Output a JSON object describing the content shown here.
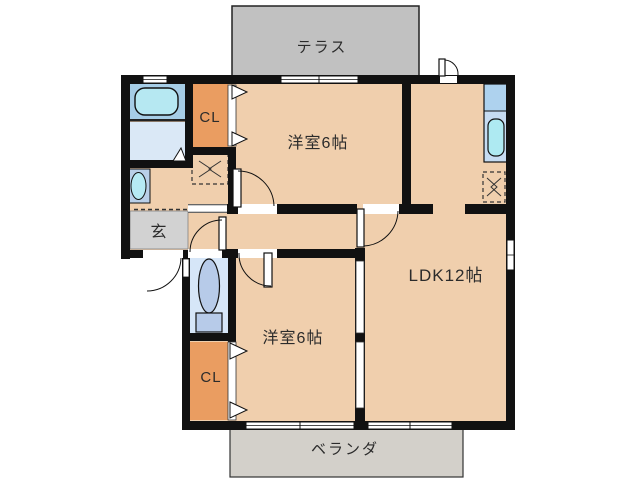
{
  "floorplan": {
    "labels": {
      "terrace": "テラス",
      "closet_upper": "CL",
      "bedroom_upper": "洋室6帖",
      "entrance": "玄",
      "ldk": "LDK12帖",
      "bedroom_lower": "洋室6帖",
      "closet_lower": "CL",
      "veranda": "ベランダ"
    },
    "colors": {
      "floor": "#f0cfad",
      "terrace": "#c1c1c1",
      "veranda": "#d3d0ca",
      "entrance_floor": "#d2d2d2",
      "closet": "#ea9d61",
      "wall": "#111111",
      "bath_room": "#a6cde6",
      "bathtub": "#b6e8f2",
      "washroom": "#dae8f6",
      "toilet_room": "#d6e6f8",
      "toilet_fixture": "#b7cbe9",
      "sink_cabinet": "#b9cfe8",
      "sink_basin": "#b6eaf4",
      "kitchen_counter_top": "#aed2ee",
      "kitchen_counter": "#c6dcf2",
      "kitchen_sink": "#aeeaf2",
      "text": "#2b2b2b"
    }
  }
}
